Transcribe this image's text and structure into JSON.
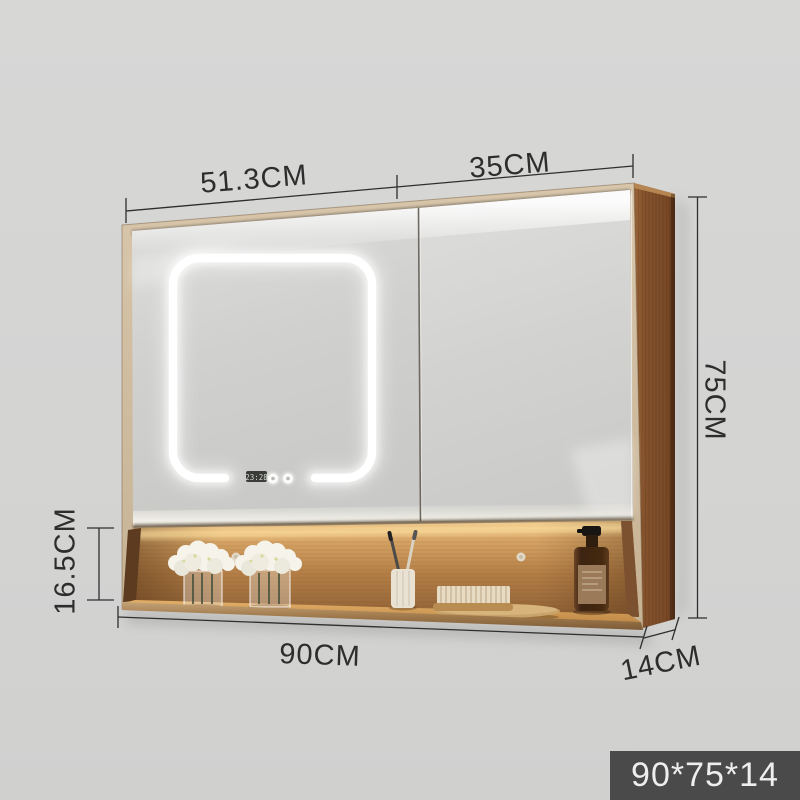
{
  "annotations": {
    "top_left_width": "51.3CM",
    "top_right_width": "35CM",
    "height": "75CM",
    "shelf_height": "16.5CM",
    "total_width": "90CM",
    "depth": "14CM"
  },
  "badge": {
    "text": "90*75*14"
  },
  "mirror": {
    "clock_time": "23:28"
  },
  "colors": {
    "background": "#d4d4d3",
    "badge_bg": "#4a4a4a",
    "badge_text": "#eeeeee",
    "dimension_text": "#2d2d2d",
    "wood_side_panel": "#7f4f2d",
    "wood_frame": "#d1bda1",
    "shelf_wood": "#b37e46",
    "led_light": "#ffffff",
    "mirror_gray": "#cfcfcd"
  }
}
